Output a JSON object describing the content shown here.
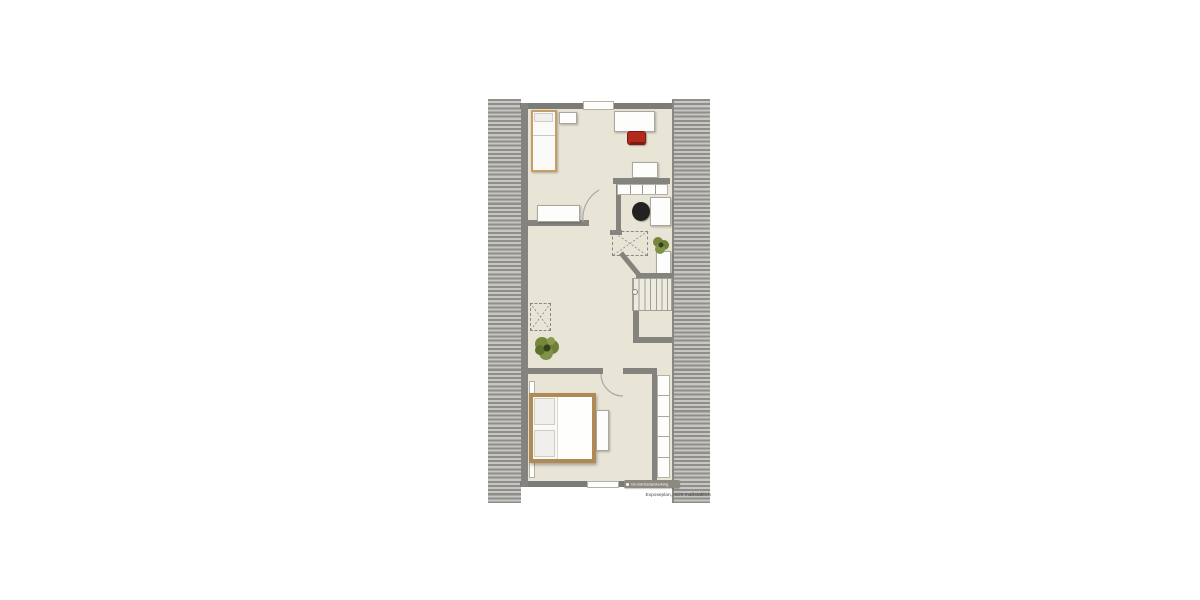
{
  "canvas": {
    "width": 1200,
    "height": 600,
    "background": "#ffffff"
  },
  "floorplan": {
    "type": "attic floor plan, top-down view",
    "caption": "Exposeplan, nicht maßstäblich",
    "watermark": "Grundrissdarstellung",
    "colors": {
      "floor": "#e8e4d6",
      "wall": "#85837d",
      "roof_hatch_bg": "#c8c6c2",
      "roof_hatch_stripe": "#908e8a",
      "bed_frame": "#b08a55",
      "chair_red": "#b22a1c",
      "chair_black": "#242220",
      "plant_green": "#6f8138",
      "furniture_white": "#fdfdfc",
      "badge_bg": "#8d8880"
    },
    "furniture": {
      "single_bed": "single bed",
      "nightstand": "nightstand",
      "desk_top": "desk",
      "red_chair": "red desk chair",
      "dresser": "dresser",
      "shelf_unit": "divided shelf unit",
      "office_desk": "desk",
      "office_chair": "black office chair",
      "skylight": "roof window projection (dashed)",
      "plant": "potted plant",
      "cabinet": "cabinet",
      "stairs": "staircase",
      "wardrobe": "built-in wardrobe",
      "double_bed": "double bed",
      "bench": "bench",
      "radiator": "radiator",
      "window": "window",
      "sideboard": "sideboard"
    }
  }
}
